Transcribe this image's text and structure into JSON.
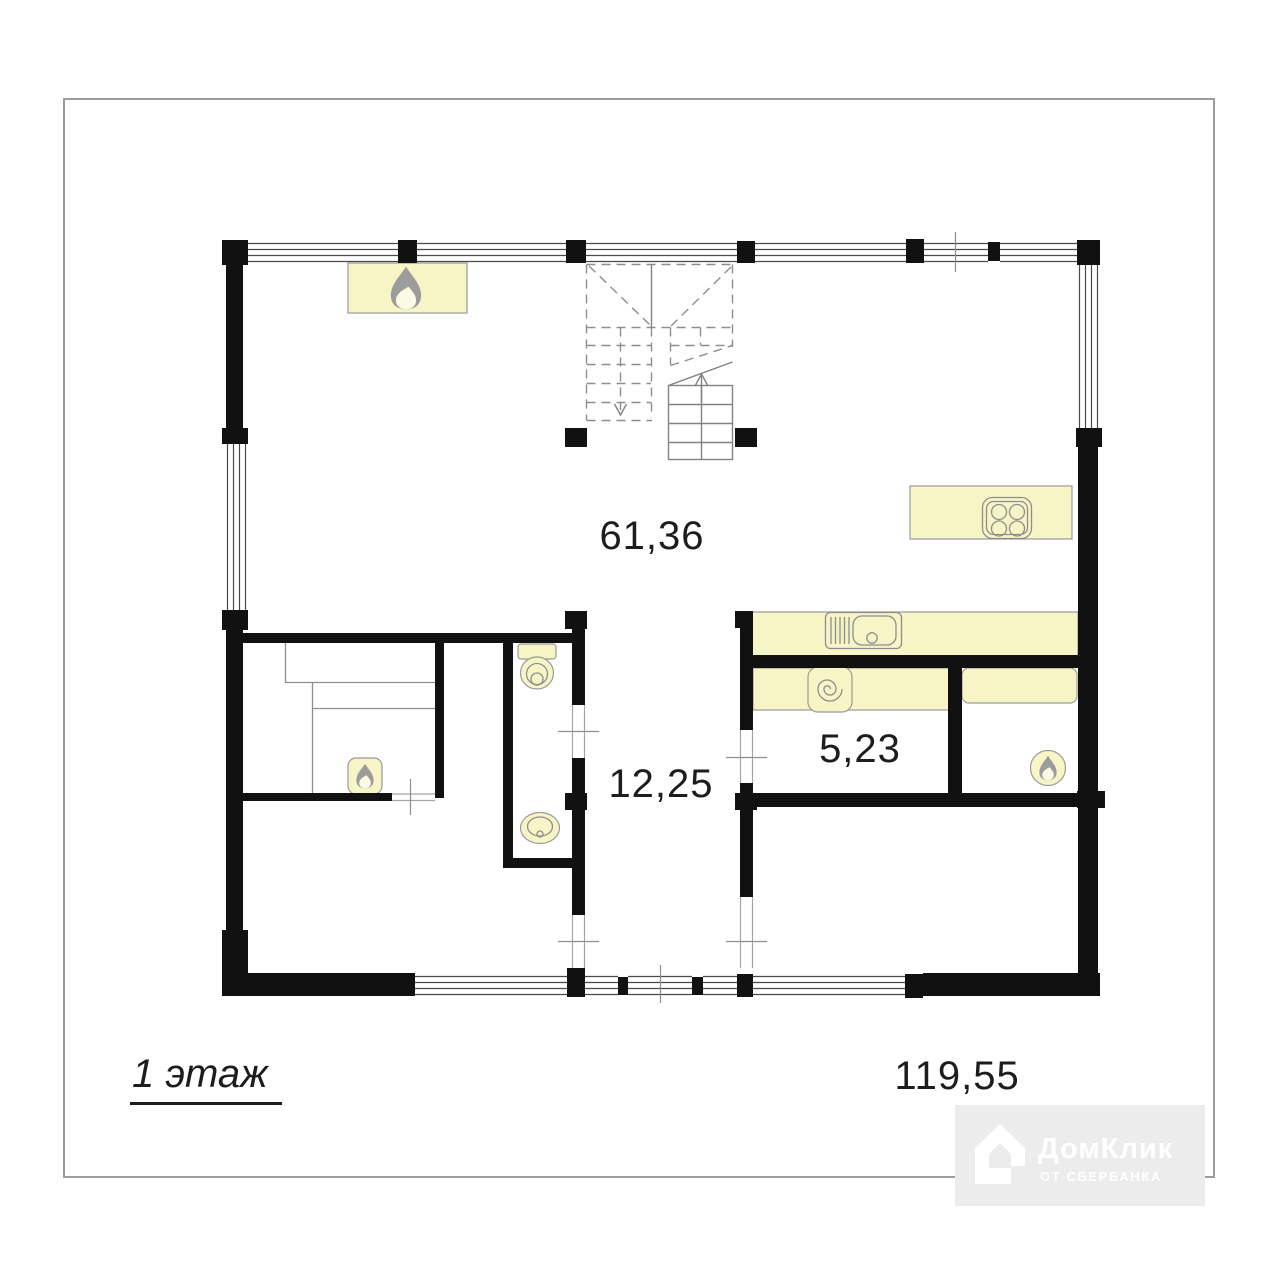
{
  "floor": {
    "label": "1 этаж"
  },
  "areas": {
    "living_room": "61,36",
    "hallway": "12,25",
    "storage": "5,23",
    "total": "119,55"
  },
  "watermark": {
    "brand": "ДомКлик",
    "subtitle": "ОТ СБЕРБАНКА"
  },
  "icons": {
    "fireplace": "flame-icon",
    "sauna_stove": "flame-icon",
    "boiler": "flame-in-circle-icon",
    "cooktop": "four-burner-stove-icon",
    "kitchen_sink": "sink-with-drainboard-icon",
    "washing_machine": "spiral-drum-icon",
    "toilet": "toilet-icon",
    "washbasin": "oval-basin-icon",
    "staircase": "stairs-with-up-down-arrows",
    "house_logo": "domclick-house-icon"
  },
  "colors": {
    "wall": "#111111",
    "furniture_fill": "#f7f4c5",
    "furniture_outline": "#9a9a9a",
    "thin_line": "#8e8e8e",
    "frame_border": "#9c9c9c",
    "badge_background": "#ececec",
    "badge_text": "#ffffff",
    "label_text": "#1d1d1d"
  }
}
